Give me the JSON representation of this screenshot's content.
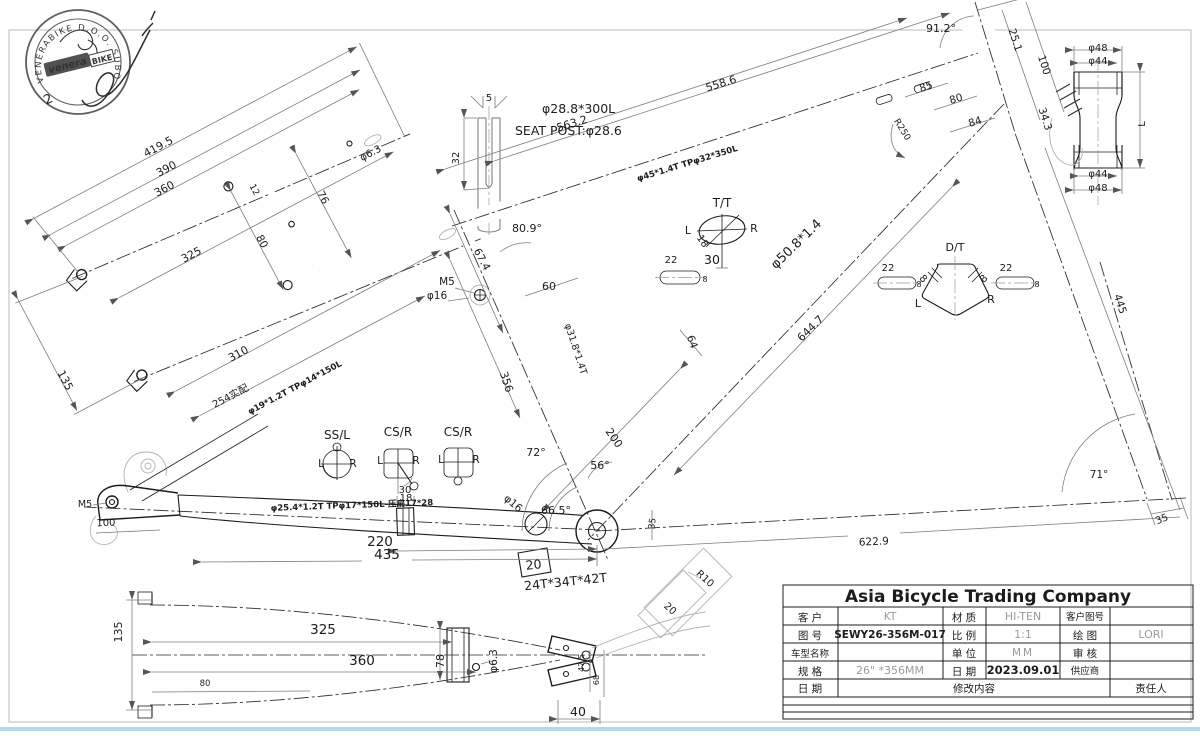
{
  "stamp": {
    "ring_text": "VENERABIKE D.O.O. SUBOTICA",
    "logo_main": "venera",
    "logo_sub": "BIKE",
    "number": "2"
  },
  "title_block": {
    "company": "Asia Bicycle Trading Company",
    "customer_label": "客  户",
    "customer": "KT",
    "material_label": "材  质",
    "material": "HI-TEN",
    "cust_dwg_label": "客户图号",
    "cust_dwg": "",
    "dwg_no_label": "图  号",
    "dwg_no": "SEWY26-356M-017",
    "scale_label": "比  例",
    "scale": "1:1",
    "drawn_label": "绘  图",
    "drawn": "LORI",
    "model_label": "车型名称",
    "model": "",
    "unit_label": "单  位",
    "unit": "MM",
    "check_label": "审  核",
    "check": "",
    "spec_label": "规  格",
    "spec": "26\" *356MM",
    "date_label": "日  期",
    "date": "2023.09.01",
    "supplier_label": "供应商",
    "supplier": "",
    "rev_date_label": "日  期",
    "rev_content_label": "修改内容",
    "rev_resp_label": "责任人"
  },
  "labels": [
    {
      "name": "ss-dim-419-5",
      "text": "419.5",
      "x": 160,
      "y": 150,
      "r": -28,
      "s": 11
    },
    {
      "name": "ss-dim-390",
      "text": "390",
      "x": 168,
      "y": 172,
      "r": -28,
      "s": 11
    },
    {
      "name": "ss-dim-360",
      "text": "360",
      "x": 166,
      "y": 192,
      "r": -28,
      "s": 11
    },
    {
      "name": "ss-dim-325",
      "text": "325",
      "x": 193,
      "y": 258,
      "r": -28,
      "s": 11
    },
    {
      "name": "ss-dim-310",
      "text": "310",
      "x": 240,
      "y": 357,
      "r": -28,
      "s": 11
    },
    {
      "name": "ss-dim-254",
      "text": "254实配",
      "x": 232,
      "y": 399,
      "r": -28,
      "s": 10
    },
    {
      "name": "ss-dim-135",
      "text": "135",
      "x": 62,
      "y": 382,
      "r": 62,
      "s": 11
    },
    {
      "name": "ss-dim-80",
      "text": "80",
      "x": 259,
      "y": 243,
      "r": 62,
      "s": 10.5
    },
    {
      "name": "ss-dim-76",
      "text": "76",
      "x": 320,
      "y": 199,
      "r": 62,
      "s": 10.5
    },
    {
      "name": "ss-dim-12",
      "text": "12",
      "x": 252,
      "y": 191,
      "r": 62,
      "s": 9
    },
    {
      "name": "ss-dim-d63",
      "text": "φ6.3",
      "x": 372,
      "y": 156,
      "r": -28,
      "s": 10
    },
    {
      "name": "ss-tube-spec",
      "text": "φ19*1.2T TPφ14*150L",
      "x": 296,
      "y": 390,
      "r": -28,
      "s": 8.5,
      "b": 1
    },
    {
      "name": "sp-dim-5",
      "text": "5",
      "x": 489,
      "y": 101,
      "s": 10
    },
    {
      "name": "sp-dim-32",
      "text": "32",
      "x": 459,
      "y": 158,
      "r": -90,
      "s": 10
    },
    {
      "name": "sp-spec",
      "text": "φ28.8*300L",
      "x": 542,
      "y": 113,
      "s": 12.5,
      "c": "#9a9a9a",
      "a": "start"
    },
    {
      "name": "sp-label",
      "text": "SEAT POST:φ28.6",
      "x": 515,
      "y": 135,
      "s": 12.5,
      "c": "#9a9a9a",
      "a": "start"
    },
    {
      "name": "tt-dim-558-6",
      "text": "558.6",
      "x": 722,
      "y": 87,
      "r": -17,
      "s": 11
    },
    {
      "name": "tt-dim-563-2",
      "text": "563.2",
      "x": 573,
      "y": 127,
      "r": -17,
      "s": 11
    },
    {
      "name": "tt-tube-spec",
      "text": "φ45*1.4T TPφ32*350L",
      "x": 688,
      "y": 166,
      "r": -17,
      "s": 8.5,
      "b": 1
    },
    {
      "name": "head-angle",
      "text": "91.2°",
      "x": 941,
      "y": 32,
      "s": 11
    },
    {
      "name": "head-dim-25-1",
      "text": "25.1",
      "x": 1012,
      "y": 41,
      "r": 72,
      "s": 10.5
    },
    {
      "name": "head-dim-100",
      "text": "100",
      "x": 1041,
      "y": 66,
      "r": 72,
      "s": 10.5
    },
    {
      "name": "head-dim-34-3",
      "text": "34.3",
      "x": 1042,
      "y": 120,
      "r": 72,
      "s": 10.5
    },
    {
      "name": "head-dim-85",
      "text": "85",
      "x": 927,
      "y": 90,
      "r": -17,
      "s": 10.5
    },
    {
      "name": "head-dim-80",
      "text": "80",
      "x": 957,
      "y": 102,
      "r": -17,
      "s": 10.5
    },
    {
      "name": "head-dim-84",
      "text": "84",
      "x": 976,
      "y": 125,
      "r": -17,
      "s": 10.5
    },
    {
      "name": "head-r250",
      "text": "R250",
      "x": 900,
      "y": 131,
      "r": 58,
      "s": 9
    },
    {
      "name": "htd-d48-top",
      "text": "φ48",
      "x": 1098,
      "y": 51,
      "s": 10
    },
    {
      "name": "htd-d44-top",
      "text": "φ44",
      "x": 1098,
      "y": 64,
      "s": 10
    },
    {
      "name": "htd-length",
      "text": "L",
      "x": 1145,
      "y": 124,
      "r": -90,
      "s": 10
    },
    {
      "name": "htd-d44-bot",
      "text": "φ44",
      "x": 1098,
      "y": 177,
      "s": 10
    },
    {
      "name": "htd-d48-bot",
      "text": "φ48",
      "x": 1098,
      "y": 191,
      "s": 10
    },
    {
      "name": "ttd-title",
      "text": "T/T",
      "x": 722,
      "y": 207,
      "s": 12
    },
    {
      "name": "ttd-left",
      "text": "L",
      "x": 688,
      "y": 234,
      "s": 11,
      "c": "#9a9a9a"
    },
    {
      "name": "ttd-right",
      "text": "R",
      "x": 754,
      "y": 232,
      "s": 11,
      "c": "#9a9a9a"
    },
    {
      "name": "ttd-dim-18",
      "text": "18",
      "x": 700,
      "y": 243,
      "r": 55,
      "s": 10
    },
    {
      "name": "ttd-dim-30",
      "text": "30",
      "x": 712,
      "y": 264,
      "s": 12.5
    },
    {
      "name": "slot1-22",
      "text": "22",
      "x": 671,
      "y": 263,
      "s": 10,
      "c": "#9a9a9a"
    },
    {
      "name": "slot1-8",
      "text": "8",
      "x": 705,
      "y": 282,
      "s": 8
    },
    {
      "name": "dtd-title",
      "text": "D/T",
      "x": 955,
      "y": 251,
      "s": 11,
      "c": "#9a9a9a"
    },
    {
      "name": "dtd-left",
      "text": "L",
      "x": 918,
      "y": 307,
      "s": 11,
      "c": "#9a9a9a"
    },
    {
      "name": "dtd-right",
      "text": "R",
      "x": 991,
      "y": 303,
      "s": 11,
      "c": "#9a9a9a"
    },
    {
      "name": "dtd-8-left",
      "text": "8",
      "x": 921,
      "y": 281,
      "r": 45,
      "s": 10
    },
    {
      "name": "dtd-8-right",
      "text": "8",
      "x": 986,
      "y": 281,
      "r": -45,
      "s": 10
    },
    {
      "name": "slot2-22",
      "text": "22",
      "x": 888,
      "y": 271,
      "s": 10,
      "c": "#9a9a9a"
    },
    {
      "name": "slot2-8",
      "text": "8",
      "x": 919,
      "y": 287,
      "s": 8
    },
    {
      "name": "slot3-22",
      "text": "22",
      "x": 1006,
      "y": 271,
      "s": 10,
      "c": "#9a9a9a"
    },
    {
      "name": "slot3-8",
      "text": "8",
      "x": 1037,
      "y": 287,
      "s": 8
    },
    {
      "name": "st-angle",
      "text": "80.9°",
      "x": 527,
      "y": 232,
      "s": 11
    },
    {
      "name": "st-dim-67-4",
      "text": "67.4",
      "x": 479,
      "y": 261,
      "r": 62,
      "s": 10.5
    },
    {
      "name": "st-m5",
      "text": "M5",
      "x": 447,
      "y": 285,
      "s": 10.5
    },
    {
      "name": "st-d16",
      "text": "φ16",
      "x": 437,
      "y": 299,
      "s": 10.5
    },
    {
      "name": "st-dim-60",
      "text": "60",
      "x": 549,
      "y": 290,
      "s": 11
    },
    {
      "name": "st-dim-356",
      "text": "356",
      "x": 503,
      "y": 383,
      "r": 72,
      "s": 11
    },
    {
      "name": "st-spec",
      "text": "φ31.8*1.4T",
      "x": 573,
      "y": 350,
      "r": 72,
      "s": 9.5
    },
    {
      "name": "angle-72",
      "text": "72°",
      "x": 536,
      "y": 456,
      "s": 11
    },
    {
      "name": "angle-66-5",
      "text": "66.5°",
      "x": 556,
      "y": 514,
      "s": 11
    },
    {
      "name": "angle-56",
      "text": "56°",
      "x": 600,
      "y": 469,
      "s": 11
    },
    {
      "name": "dim-200",
      "text": "200",
      "x": 611,
      "y": 440,
      "r": 55,
      "s": 11
    },
    {
      "name": "dim-64",
      "text": "64",
      "x": 689,
      "y": 343,
      "r": 70,
      "s": 10.5
    },
    {
      "name": "dt-dim-644-7",
      "text": "644.7",
      "x": 813,
      "y": 331,
      "r": -44,
      "s": 11
    },
    {
      "name": "dt-spec",
      "text": "φ50.8*1.4",
      "x": 799,
      "y": 247,
      "r": -44,
      "s": 13
    },
    {
      "name": "dim-445",
      "text": "445",
      "x": 1117,
      "y": 305,
      "r": 72,
      "s": 10.5,
      "c": "#9a9a9a"
    },
    {
      "name": "angle-71",
      "text": "71°",
      "x": 1099,
      "y": 478,
      "s": 10.5,
      "c": "#9a9a9a"
    },
    {
      "name": "dim-622-9",
      "text": "622.9",
      "x": 874,
      "y": 545,
      "r": -3,
      "s": 10.5,
      "c": "#777777"
    },
    {
      "name": "dim-35-fork",
      "text": "35",
      "x": 1163,
      "y": 522,
      "r": -22,
      "s": 10,
      "c": "#9a9a9a"
    },
    {
      "name": "dim-35-bb",
      "text": "35",
      "x": 655,
      "y": 524,
      "r": -82,
      "s": 9,
      "c": "#9a9a9a"
    },
    {
      "name": "bb-d16",
      "text": "φ16",
      "x": 511,
      "y": 506,
      "r": 40,
      "s": 10.5
    },
    {
      "name": "bb-20-box",
      "text": "20",
      "x": 534,
      "y": 569,
      "r": -6,
      "s": 12.5
    },
    {
      "name": "bb-gears",
      "text": "24T*34T*42T",
      "x": 566,
      "y": 586,
      "r": -6,
      "s": 12.5
    },
    {
      "name": "kickstand-r10",
      "text": "R10",
      "x": 703,
      "y": 581,
      "r": 42,
      "s": 10,
      "c": "#9a9a9a"
    },
    {
      "name": "kickstand-20",
      "text": "20",
      "x": 668,
      "y": 611,
      "r": 42,
      "s": 10,
      "c": "#9a9a9a"
    },
    {
      "name": "cs-tube-spec",
      "text": "φ25.4*1.2T TPφ17*150L-压扁17*28",
      "x": 352,
      "y": 508,
      "r": -2,
      "s": 8.5,
      "b": 1
    },
    {
      "name": "cs-m5",
      "text": "M5",
      "x": 85,
      "y": 507,
      "s": 9.5
    },
    {
      "name": "cs-dim-100",
      "text": "100",
      "x": 106,
      "y": 526,
      "r": -2,
      "s": 10,
      "c": "#555555"
    },
    {
      "name": "cs-dim-18",
      "text": "18",
      "x": 406,
      "y": 501,
      "s": 10
    },
    {
      "name": "cs-dim-220",
      "text": "220",
      "x": 380,
      "y": 546,
      "s": 13.5
    },
    {
      "name": "cs-dim-435",
      "text": "435",
      "x": 387,
      "y": 559,
      "s": 13.5
    },
    {
      "name": "section-ssl",
      "text": "SS/L",
      "x": 337,
      "y": 439,
      "s": 12
    },
    {
      "name": "ssl-left",
      "text": "L",
      "x": 321,
      "y": 467,
      "s": 10.5
    },
    {
      "name": "ssl-right",
      "text": "R",
      "x": 353,
      "y": 467,
      "s": 10.5
    },
    {
      "name": "section-csr-1",
      "text": "CS/R",
      "x": 398,
      "y": 436,
      "s": 12
    },
    {
      "name": "csr1-left",
      "text": "L",
      "x": 380,
      "y": 464,
      "s": 10.5
    },
    {
      "name": "csr1-right",
      "text": "R",
      "x": 416,
      "y": 464,
      "s": 10.5
    },
    {
      "name": "csr1-dim-30",
      "text": "30",
      "x": 405,
      "y": 493,
      "s": 10
    },
    {
      "name": "section-csr-2",
      "text": "CS/R",
      "x": 458,
      "y": 436,
      "s": 12
    },
    {
      "name": "csr2-left",
      "text": "L",
      "x": 441,
      "y": 463,
      "s": 10.5
    },
    {
      "name": "csr2-right",
      "text": "R",
      "x": 476,
      "y": 463,
      "s": 10.5
    },
    {
      "name": "ct-dim-135",
      "text": "135",
      "x": 122,
      "y": 632,
      "r": -90,
      "s": 11
    },
    {
      "name": "ct-dim-325",
      "text": "325",
      "x": 323,
      "y": 634,
      "s": 13.5
    },
    {
      "name": "ct-dim-360",
      "text": "360",
      "x": 362,
      "y": 665,
      "s": 13.5
    },
    {
      "name": "ct-dim-78",
      "text": "78",
      "x": 444,
      "y": 661,
      "r": -90,
      "s": 11
    },
    {
      "name": "ct-dim-d63",
      "text": "φ6.3",
      "x": 497,
      "y": 661,
      "r": -90,
      "s": 10.5
    },
    {
      "name": "ct-dim-80",
      "text": "80",
      "x": 205,
      "y": 686,
      "s": 8.5,
      "c": "#9a9a9a"
    },
    {
      "name": "ct-dim-47-5",
      "text": "47.5",
      "x": 584,
      "y": 663,
      "r": -90,
      "s": 8,
      "c": "#9a9a9a"
    },
    {
      "name": "ct-dim-68",
      "text": "68",
      "x": 599,
      "y": 680,
      "r": -90,
      "s": 8,
      "c": "#9a9a9a"
    },
    {
      "name": "ct-dim-40",
      "text": "40",
      "x": 578,
      "y": 716,
      "s": 12.5
    },
    {
      "name": "stamp-number",
      "text": "2",
      "x": 50,
      "y": 103,
      "r": -25,
      "s": 13,
      "c": "#555555"
    }
  ]
}
